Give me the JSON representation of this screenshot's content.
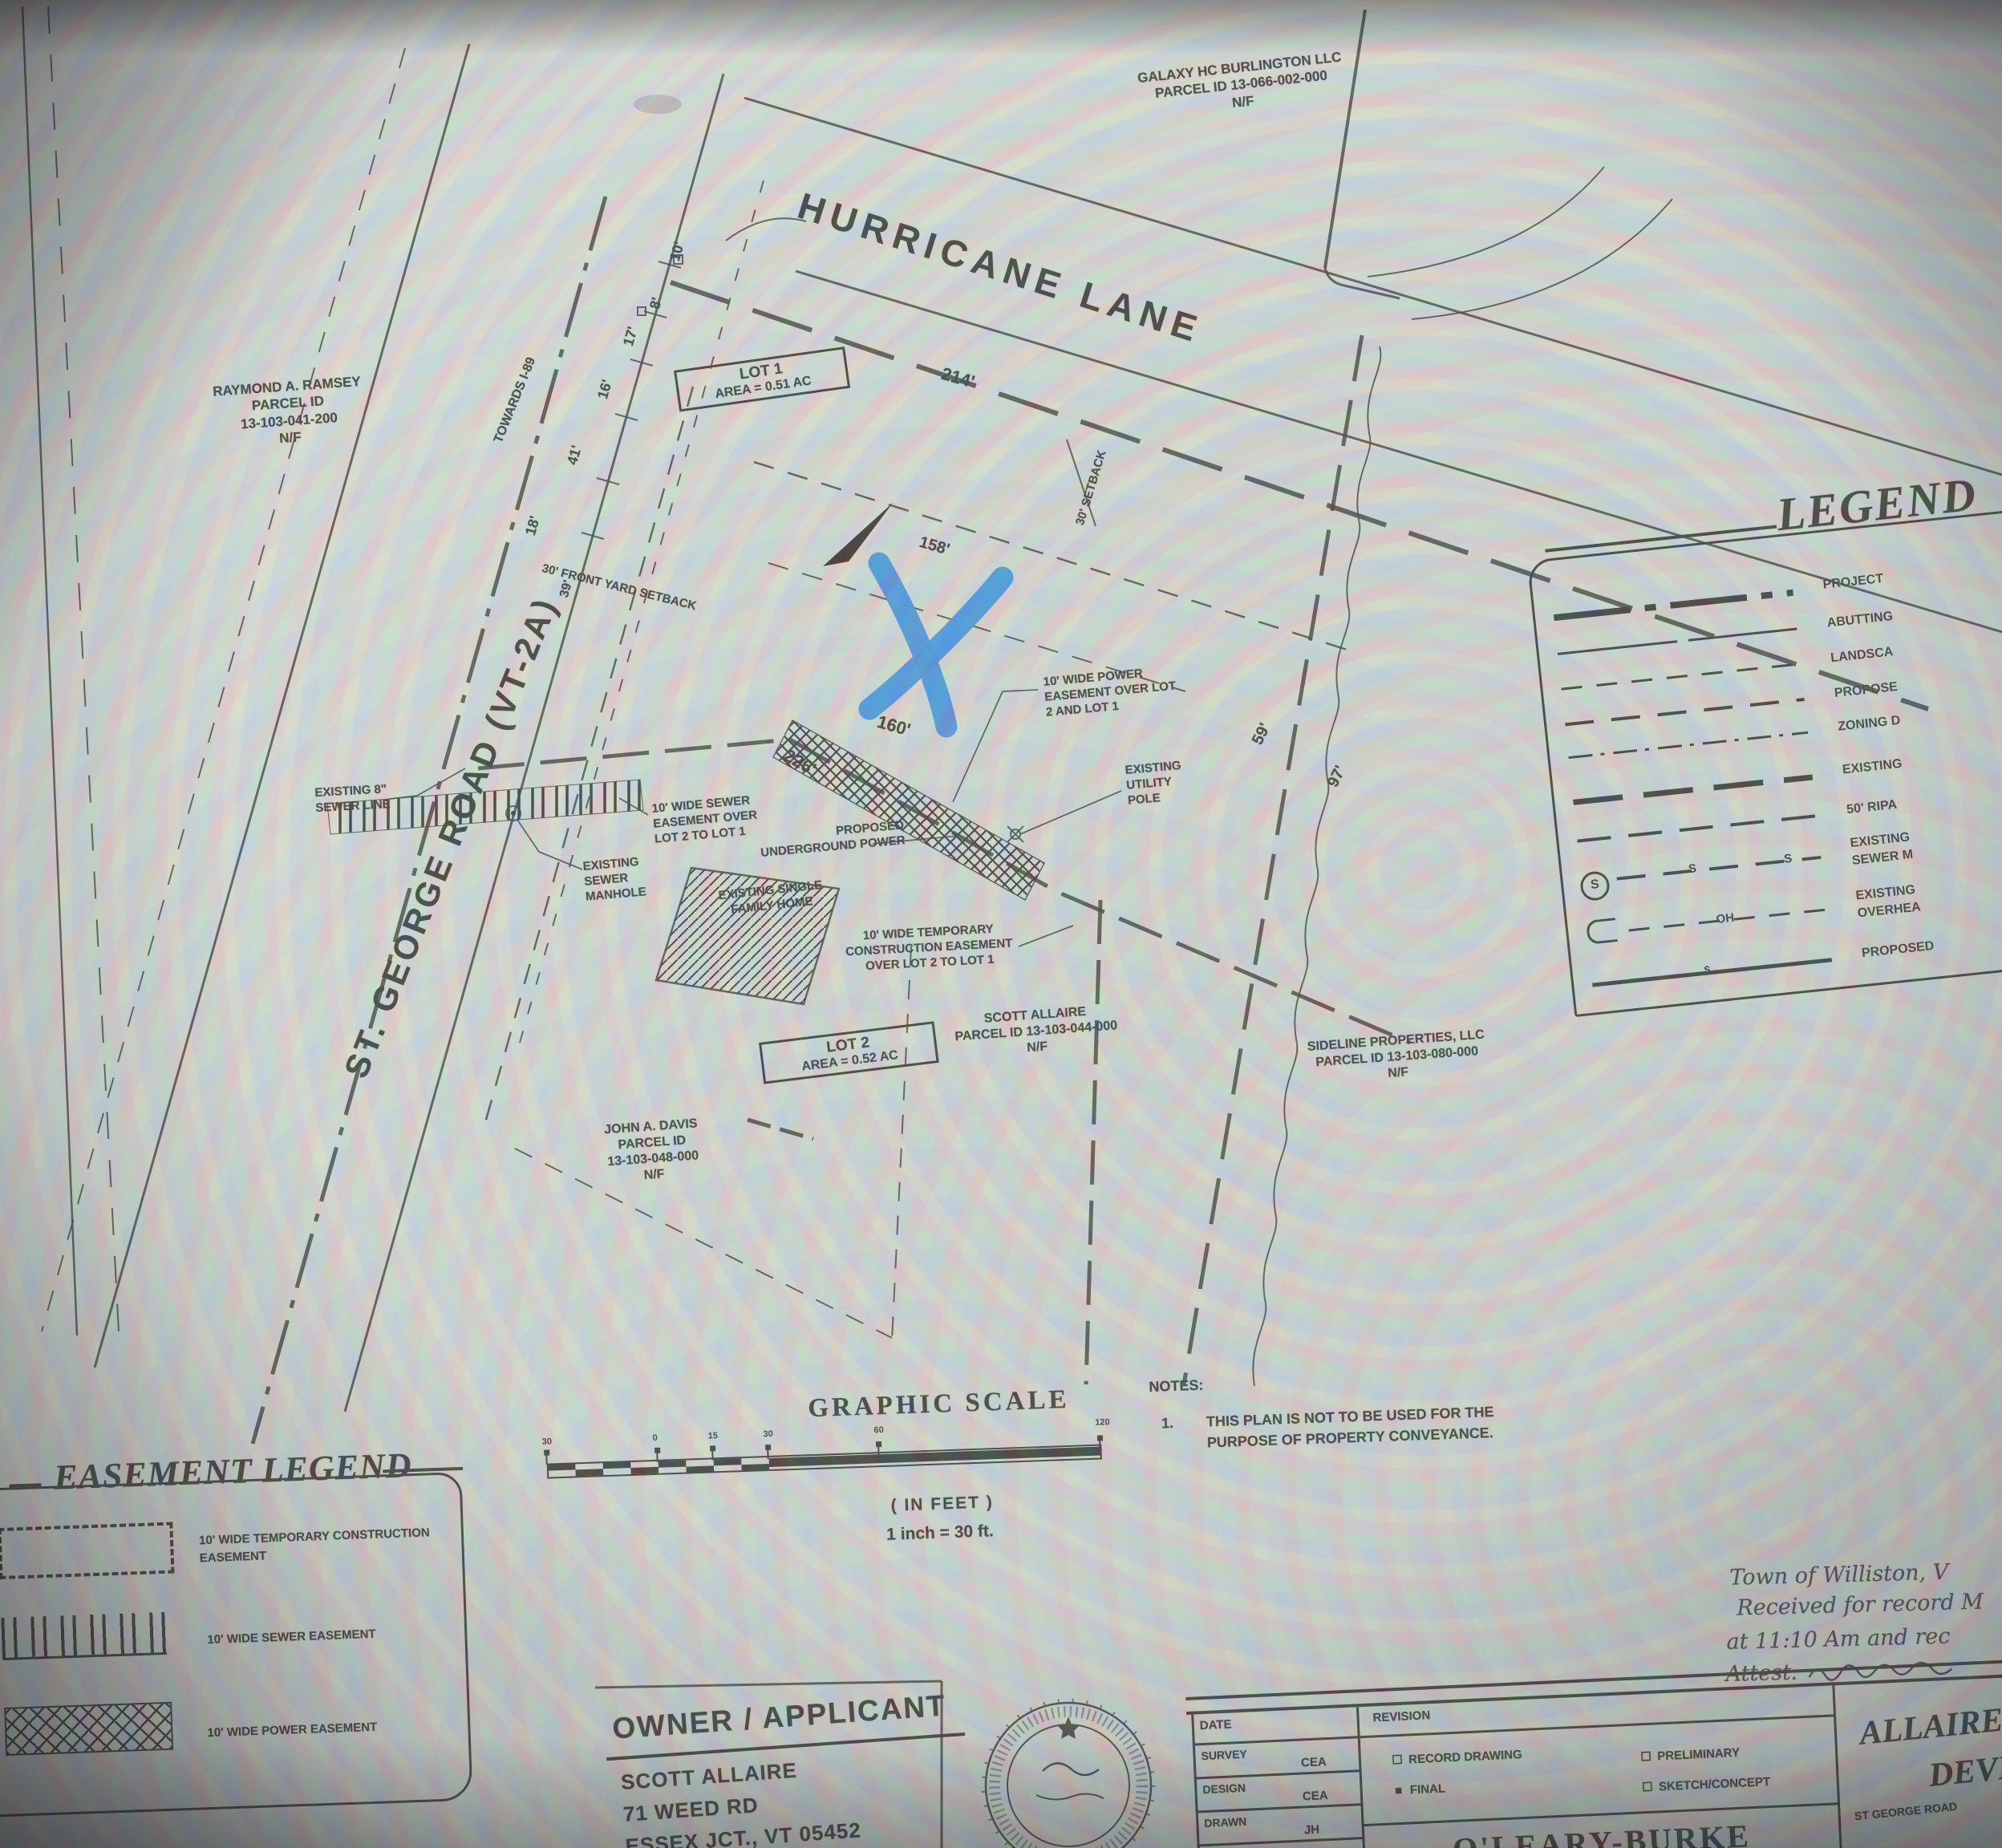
{
  "roads": {
    "hurricane": "HURRICANE LANE",
    "st_george": "ST. GEORGE ROAD (VT-2A)",
    "towards": "TOWARDS I-89"
  },
  "lots": {
    "lot1_name": "LOT 1",
    "lot1_area": "AREA = 0.51 AC",
    "lot2_name": "LOT 2",
    "lot2_area": "AREA = 0.52 AC"
  },
  "parcels": {
    "galaxy": [
      "GALAXY HC BURLINGTON LLC",
      "PARCEL ID  13-066-002-000",
      "N/F"
    ],
    "ramsey": [
      "RAYMOND A. RAMSEY",
      "PARCEL ID",
      "13-103-041-200",
      "N/F"
    ],
    "allaire": [
      "SCOTT ALLAIRE",
      "PARCEL ID 13-103-044-000",
      "N/F"
    ],
    "sideline": [
      "SIDELINE PROPERTIES, LLC",
      "PARCEL ID  13-103-080-000",
      "N/F"
    ],
    "davis": [
      "JOHN A. DAVIS",
      "PARCEL ID",
      "13-103-048-000",
      "N/F"
    ]
  },
  "dims": {
    "d10": "10'",
    "d8": "8'",
    "d17": "17'",
    "d16": "16'",
    "d41": "41'",
    "d18": "18'",
    "d39": "39'",
    "d214": "214'",
    "d158": "158'",
    "d160": "160'",
    "d226": "226'",
    "d59": "59'",
    "d97": "97'"
  },
  "setbacks": {
    "front": "30' FRONT YARD SETBACK",
    "side": "30' SETBACK"
  },
  "callouts": {
    "power_easement": [
      "10' WIDE POWER",
      "EASEMENT OVER LOT",
      "2 AND LOT 1"
    ],
    "utility_pole": [
      "EXISTING",
      "UTILITY",
      "POLE"
    ],
    "sewer_easement": [
      "10' WIDE SEWER",
      "EASEMENT OVER",
      "LOT 2 TO LOT 1"
    ],
    "manhole": [
      "EXISTING",
      "SEWER",
      "MANHOLE"
    ],
    "underground_power": [
      "PROPOSED",
      "UNDERGROUND POWER"
    ],
    "single_family": [
      "EXISTING SINGLE",
      "FAMILY HOME"
    ],
    "temp_construction": [
      "10' WIDE TEMPORARY",
      "CONSTRUCTION EASEMENT",
      "OVER LOT 2 TO LOT 1"
    ],
    "sewer_line": [
      "EXISTING 8\"",
      "SEWER LINE"
    ]
  },
  "legend": {
    "title": "LEGEND",
    "rows": [
      {
        "l1": "PROJECT"
      },
      {
        "l1": "ABUTTING"
      },
      {
        "l1": "LANDSCA"
      },
      {
        "l1": "PROPOSE"
      },
      {
        "l1": "ZONING D"
      },
      {
        "l1": "EXISTING"
      },
      {
        "l1": "50' RIPA"
      },
      {
        "l1": "EXISTING",
        "l2": "SEWER M"
      },
      {
        "l1": "EXISTING",
        "l2": "OVERHEA"
      },
      {
        "l1": "PROPOSED"
      }
    ],
    "s_mark": "S",
    "oh_mark": "OH",
    "ps_mark": "s",
    "circle_s": "S"
  },
  "easement_legend": {
    "title": "EASEMENT LEGEND",
    "rows": [
      {
        "l1": "10' WIDE TEMPORARY CONSTRUCTION",
        "l2": "EASEMENT"
      },
      {
        "l1": "10' WIDE SEWER EASEMENT"
      },
      {
        "l1": "10' WIDE POWER EASEMENT"
      }
    ]
  },
  "scale": {
    "title": "GRAPHIC SCALE",
    "unit": "( IN FEET )",
    "ratio": "1 inch = 30  ft.",
    "ticks": [
      "30",
      "0",
      "15",
      "30",
      "60",
      "120"
    ]
  },
  "notes": {
    "title": "NOTES:",
    "num": "1.",
    "line1": "THIS PLAN IS NOT TO BE USED FOR THE",
    "line2": "PURPOSE OF PROPERTY CONVEYANCE."
  },
  "owner": {
    "title": "OWNER / APPLICANT",
    "name": "SCOTT ALLAIRE",
    "addr1": "71 WEED RD",
    "addr2": "ESSEX JCT., VT 05452"
  },
  "handwriting": {
    "line1": "Town of Williston, V",
    "line2": "Received for record M",
    "line3": "at 11:10 Am and rec",
    "line4": "Attest:"
  },
  "title_block": {
    "date_label": "DATE",
    "revision_label": "REVISION",
    "rows": [
      {
        "label": "SURVEY",
        "value": "CEA"
      },
      {
        "label": "DESIGN",
        "value": "CEA"
      },
      {
        "label": "DRAWN",
        "value": "JH"
      },
      {
        "label": "CHECKED",
        "value": ""
      }
    ],
    "checks": [
      {
        "mark": "☐",
        "label": "RECORD DRAWING"
      },
      {
        "mark": "■",
        "label": "FINAL"
      },
      {
        "mark": "☐",
        "label": "PRELIMINARY"
      },
      {
        "mark": "☐",
        "label": "SKETCH/CONCEPT"
      }
    ],
    "firm1": "O'LEARY-BURKE",
    "firm2": "CIVIL ASSOCIATES",
    "project1": "ALLAIRE RESIDE",
    "project2": "DEVELOPME",
    "address": "ST GEORGE ROAD"
  }
}
